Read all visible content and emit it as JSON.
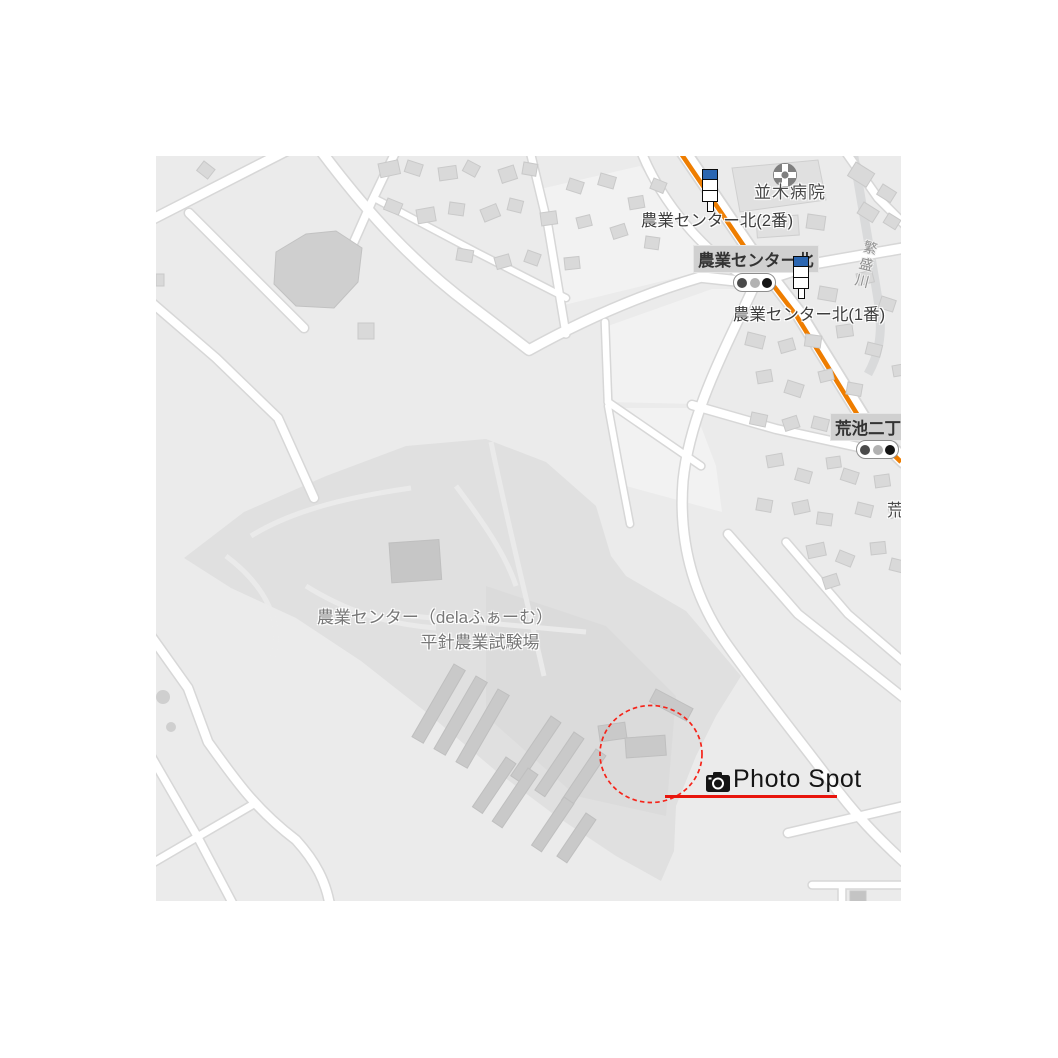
{
  "map": {
    "kind": "grayscale-street-map",
    "labels": {
      "hospital": "並木病院",
      "bus_stop_2": "農業センター北(2番)",
      "bus_stop_1": "農業センター北(1番)",
      "intersection_nogyo_center_kita": "農業センター北",
      "intersection_araike_2chome": "荒池二丁",
      "araike_partial": "荒",
      "river": "繁盛川",
      "facility_name_line1": "農業センター（delaふぁーむ）",
      "facility_name_line2": "平針農業試験場"
    },
    "icons": {
      "hospital_icon": "hospital-cross-icon",
      "bus_stop_icon": "bus-stop-pole-icon",
      "traffic_light_icon": "traffic-light-icon"
    },
    "colors": {
      "background": "#ebebeb",
      "road": "#ffffff",
      "road_casing": "#d7d7d7",
      "building": "#d9d9d9",
      "facility_area": "#e0e0e0",
      "highway_orange": "#ee7d00",
      "bus_stop_blue": "#2b66b1"
    }
  },
  "annotation": {
    "photo_spot_label": "Photo Spot",
    "camera_icon": "camera-icon",
    "red": "#e8150d"
  }
}
